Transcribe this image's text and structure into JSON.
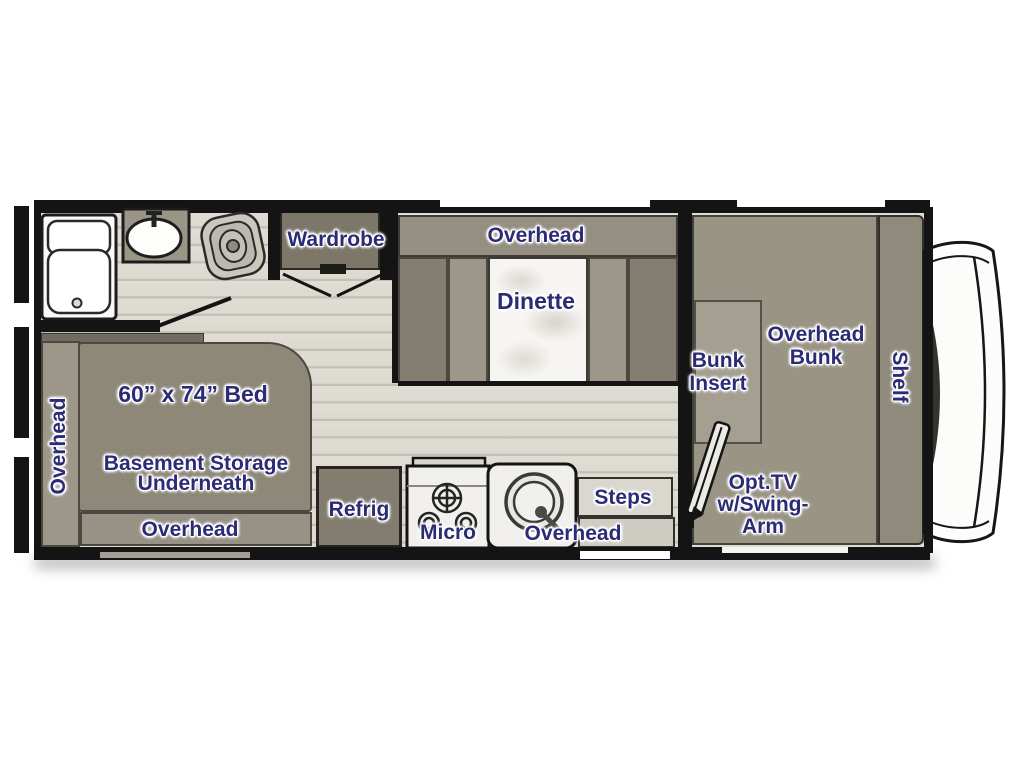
{
  "floorplan": {
    "type": "rv-class-c-motorhome-floorplan",
    "colors": {
      "wall": "#141414",
      "floor": "#dedbd3",
      "plank_line": "#c3bfb4",
      "furniture": "#8f8979",
      "furniture_dark": "#7d7769",
      "furniture_light": "#a59f92",
      "fixture_white": "#f2f0ec",
      "label_text": "#2b2b76",
      "label_outline": "#ffffff"
    },
    "labels": {
      "wardrobe": "Wardrobe",
      "dinette_overhead": "Overhead",
      "dinette": "Dinette",
      "bed_overhead_side": "Overhead",
      "bed_size": "60” x 74” Bed",
      "basement_storage_1": "Basement Storage",
      "basement_storage_2": "Underneath",
      "bed_overhead_bottom": "Overhead",
      "refrig": "Refrig",
      "micro": "Micro",
      "kitchen_overhead": "Overhead",
      "steps": "Steps",
      "bunk_insert_1": "Bunk",
      "bunk_insert_2": "Insert",
      "overhead_bunk_1": "Overhead",
      "overhead_bunk_2": "Bunk",
      "shelf": "Shelf",
      "opt_tv_1": "Opt.TV",
      "opt_tv_2": "w/Swing-",
      "opt_tv_3": "Arm"
    }
  }
}
